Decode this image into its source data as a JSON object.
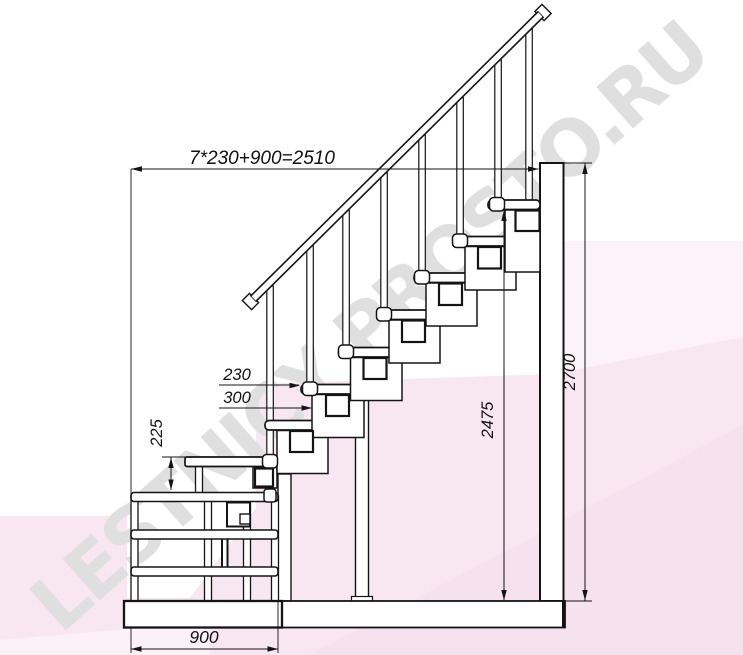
{
  "watermark": {
    "text": "LESTNICY PROSTO.RU"
  },
  "dimensions": {
    "total_run": "7*230+900=2510",
    "going": "230",
    "tread_depth": "300",
    "first_rise": "225",
    "height_to_top_tread": "2475",
    "total_height": "2700",
    "platform_depth": "900"
  },
  "colors": {
    "line": "#141414",
    "pink_main": "#f8e7f1",
    "pink_light": "#fcf2f8",
    "pink_deep": "#f4dcec",
    "watermark_gray": "#dfdfdf"
  }
}
